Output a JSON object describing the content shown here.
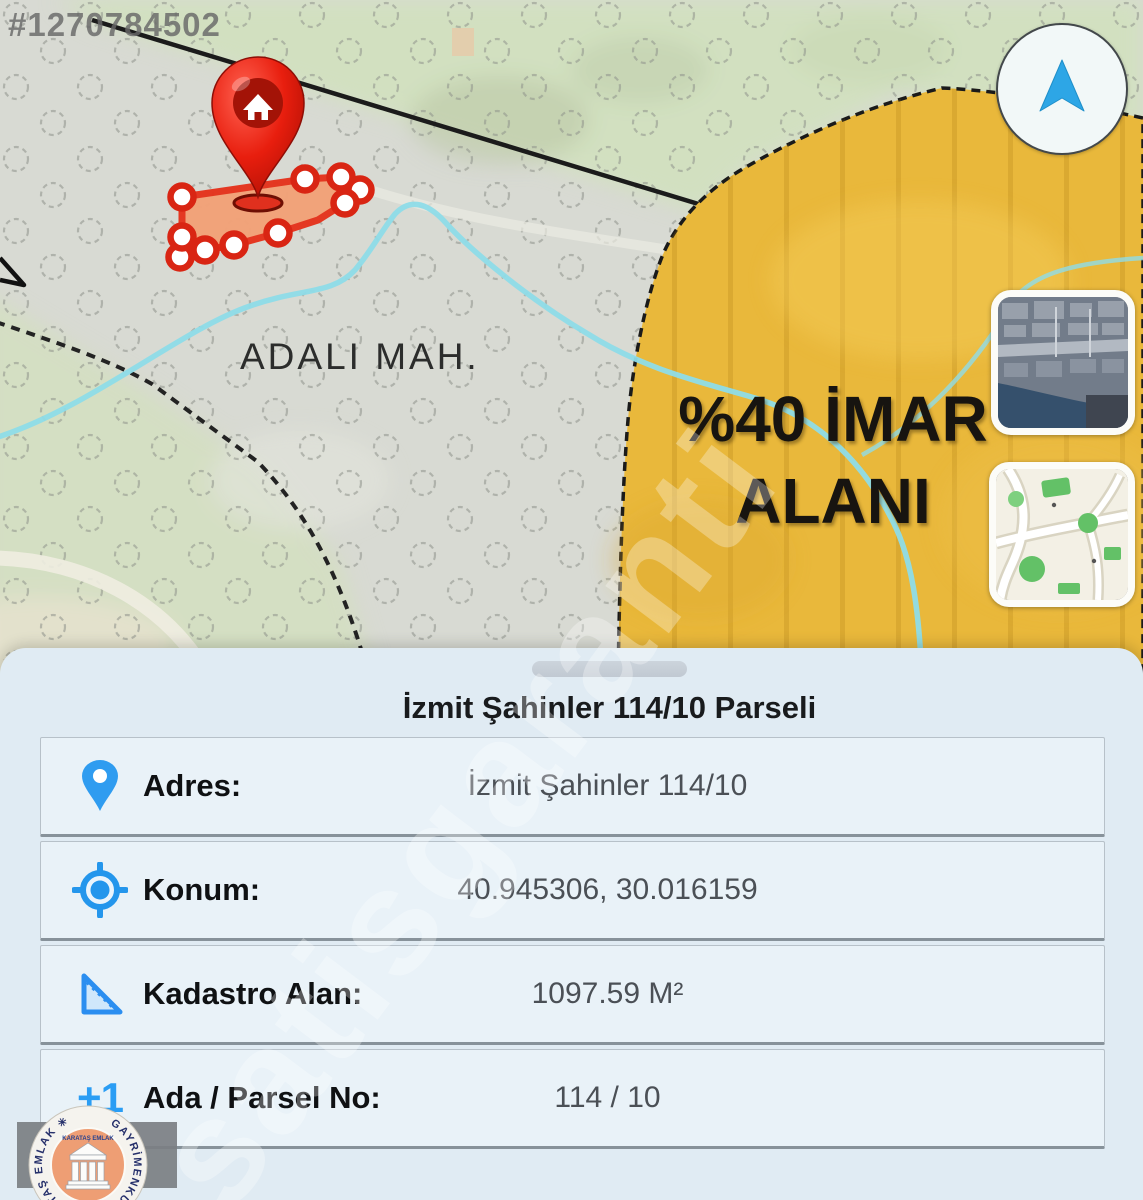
{
  "watermarks": {
    "photo_id": "#1270784502",
    "diagonal": "satisgaranti"
  },
  "map": {
    "district_label": "ADALI MAH.",
    "zone_label": {
      "line1": "%40 İMAR",
      "line2": "ALANI"
    },
    "colors": {
      "zone_yellow": "#e9b83b",
      "parcel_fill": "#f2a277",
      "parcel_stroke": "#e5331c",
      "stream_blue": "#8edce8",
      "pin_red": "#e81e0e",
      "accent_blue": "#2f9cf0"
    }
  },
  "panel": {
    "title": "İzmit Şahinler 114/10 Parseli",
    "rows": [
      {
        "icon": "location-pin-icon",
        "label": "Adres:",
        "value": "İzmit Şahinler 114/10"
      },
      {
        "icon": "gps-target-icon",
        "label": "Konum:",
        "value": "40.945306, 30.016159"
      },
      {
        "icon": "set-square-icon",
        "label": "Kadastro Alan:",
        "value": "1097.59 M²"
      },
      {
        "icon": "plus-one-icon",
        "label": "Ada / Parsel No:",
        "value": "114 / 10"
      }
    ],
    "plus_one_text": "+1"
  },
  "logo": {
    "ring_text": "GAYRİMENKUL ✳ KARATAŞ EMLAK ✳",
    "center_text": "KARATAŞ EMLAK"
  }
}
